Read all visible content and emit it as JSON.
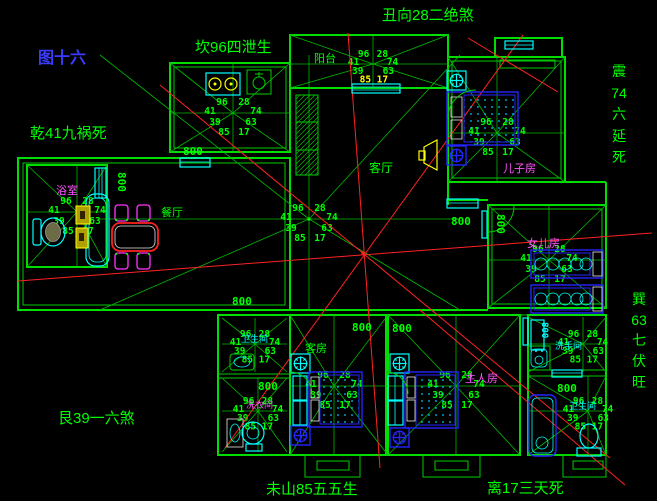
{
  "figure": {
    "title": "图十六"
  },
  "annotations": {
    "top": "丑向28二绝煞",
    "top_left": "坎96四泄生",
    "left": "乾41九祸死",
    "bottom_left": "艮39一六煞",
    "bottom_center": "未山85五五生",
    "bottom_right": "离17三天死",
    "right_upper": [
      "震",
      "74",
      "六",
      "延",
      "死"
    ],
    "right_lower": [
      "巽",
      "63",
      "七",
      "伏",
      "旺"
    ]
  },
  "rooms": {
    "balcony": "阳台",
    "living": "客厅",
    "dining": "餐厅",
    "son": "儿子房",
    "daughter": "女儿房",
    "guest": "客房",
    "master": "主人房",
    "bath_left": "浴室",
    "bath_bl_top": "卫生间",
    "laundry": "洗衣间",
    "washroom": "洗手间",
    "bath_br": "卫生间"
  },
  "star_numbers": [
    "96",
    "28",
    "41",
    "74",
    "39",
    "63",
    "85",
    "17"
  ],
  "dim_label": "800",
  "colors": {
    "wall": "#00dd00",
    "sightline": "#ff2222",
    "fixture": "#00ffff",
    "furniture": "#2424ff",
    "highlight": "#ffff00",
    "room_label": "#ff55ff",
    "figure_label": "#3b3bff"
  }
}
